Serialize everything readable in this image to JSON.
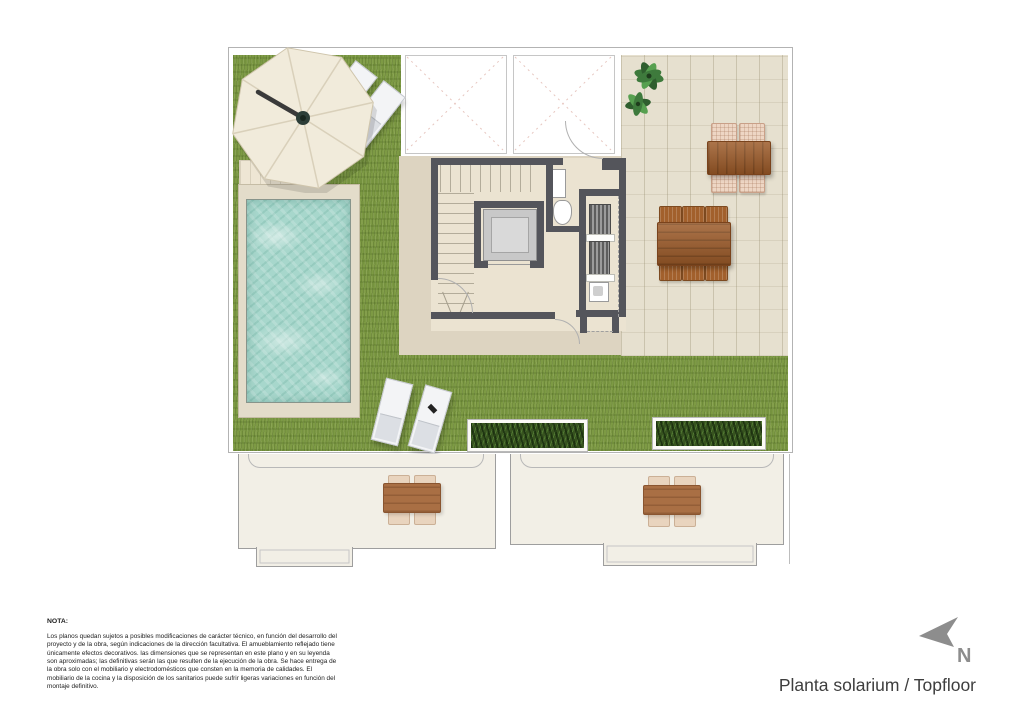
{
  "title_block": {
    "plan_title": "Planta solarium / Topfloor"
  },
  "compass": {
    "label": "N"
  },
  "note": {
    "heading": "NOTA:",
    "body": "Los planos quedan sujetos a posibles modificaciones de carácter técnico, en función del desarrollo del proyecto y de la obra, según indicaciones de la dirección facultativa. El amueblamiento reflejado tiene únicamente efectos decorativos. las dimensiones que se representan en este plano y en su leyenda son aproximadas; las definitivas serán las que resulten de la ejecución de la obra. Se hace entrega de la obra solo con el mobiliario y electrodomésticos que consten en la memoria de calidades. El mobiliario de la cocina y la disposición de los sanitarios puede sufrir ligeras variaciones en función del montaje definitivo."
  },
  "colors": {
    "grass": "#7d9a44",
    "paving_center": "#ddd4c1",
    "paving_terrace": "#e6e0cf",
    "pool_water": "#a7d7cc",
    "pool_deck": "#e3dcca",
    "wall": "#54555b",
    "wood": "#9c5a28",
    "umbrella": "#f1ebdb",
    "lower_floor": "#f2efe6",
    "title_text": "#3e3e3e",
    "compass": "#8d8d8d",
    "planter_green": "#37531f",
    "chair_cushion": "#eed6c4",
    "chair_brown": "#a2602c",
    "note_text": "#1c1c1c"
  }
}
